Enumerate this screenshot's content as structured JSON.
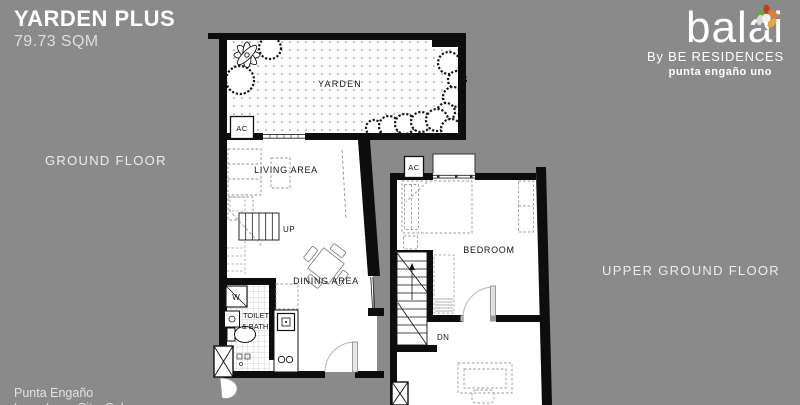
{
  "header": {
    "title": "YARDEN PLUS",
    "area": "79.73 SQM"
  },
  "floor_labels": {
    "ground": "GROUND FLOOR",
    "upper": "UPPER GROUND FLOOR"
  },
  "logo": {
    "brand": "balai",
    "byline": "By BE RESIDENCES",
    "project": "punta engaño uno"
  },
  "footer": {
    "line1": "Punta Engaño",
    "line2": "Lapu-Lapu City, Cebu"
  },
  "plan_labels": {
    "ground": {
      "yarden": "YARDEN",
      "ac": "AC",
      "living": "LIVING AREA",
      "up": "UP",
      "dining": "DINING AREA",
      "washer": "W",
      "toilet1": "TOILET",
      "toilet2": "& BATH"
    },
    "upper": {
      "ac": "AC",
      "bedroom": "BEDROOM",
      "down": "DN"
    }
  },
  "colors": {
    "background": "#8a8a8a",
    "plan_ink": "#0d0d0d",
    "petals": [
      "#6aa63f",
      "#c8382e",
      "#e0812f",
      "#d9d9d9",
      "#8f8f8f",
      "#eda63b"
    ]
  }
}
